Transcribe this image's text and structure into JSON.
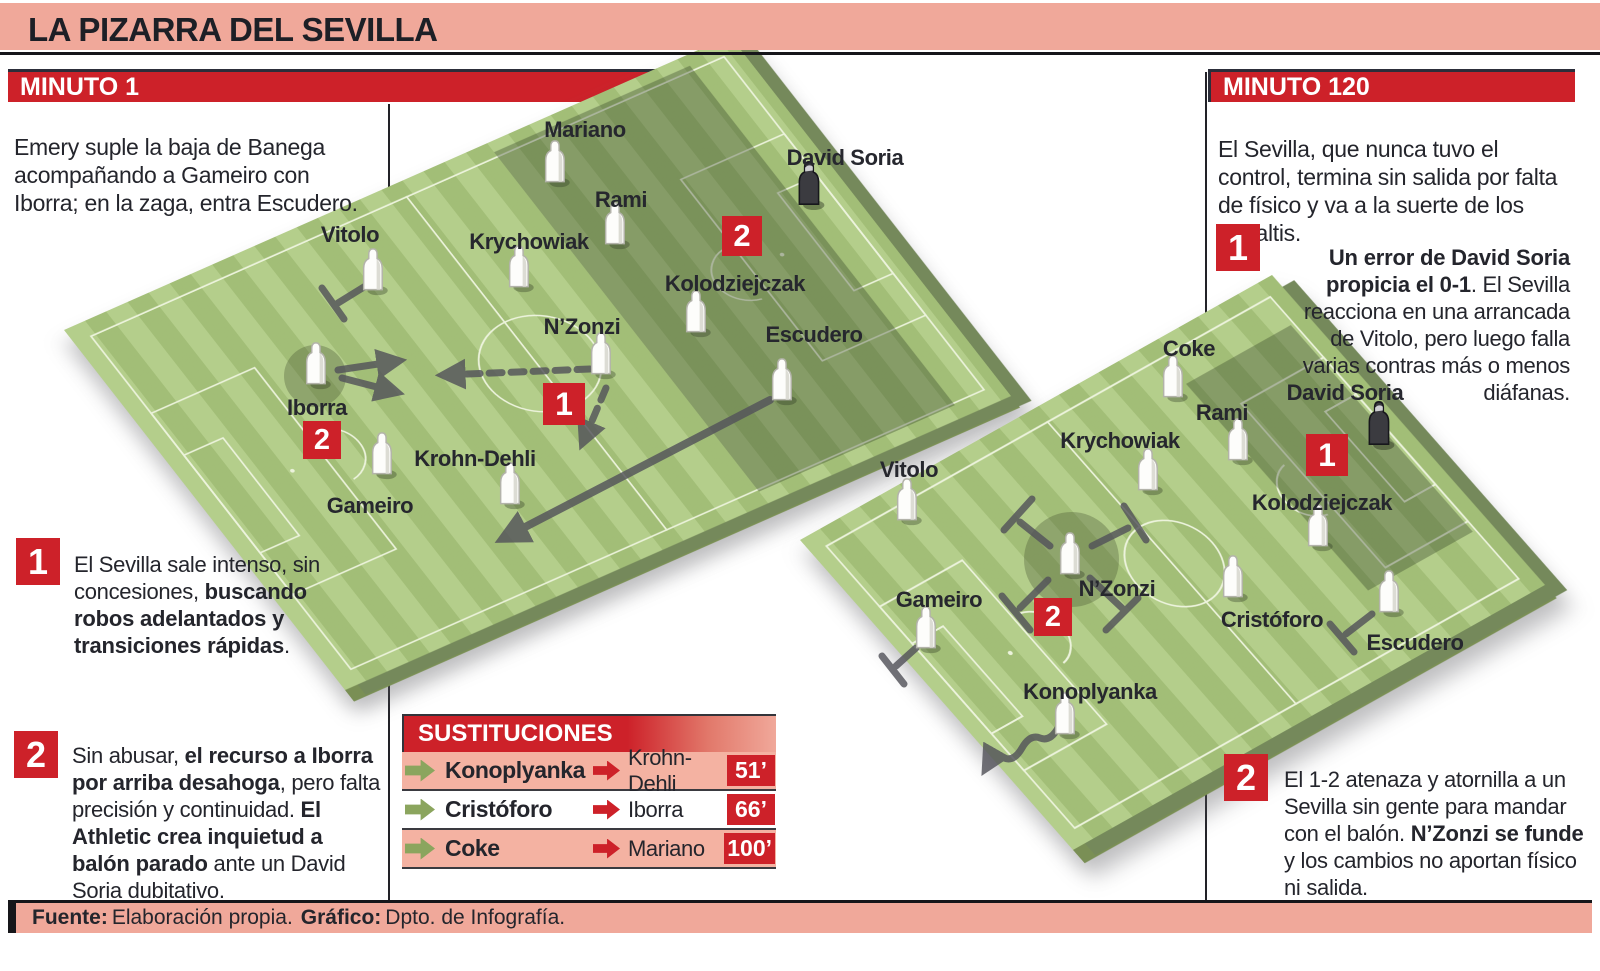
{
  "title": "LA PIZARRA DEL SEVILLA",
  "minuto1": {
    "header": "MINUTO 1",
    "intro": "Emery suple la baja de Banega acompañando a Gameiro con Iborra; en la zaga, entra Escudero.",
    "note1": {
      "num": "1",
      "s0": "El Sevilla sale intenso, sin concesiones, ",
      "b1": "buscando robos adelantados y transiciones rápidas",
      "s2": "."
    },
    "note2": {
      "num": "2",
      "s0": "Sin abusar, ",
      "b1": "el recurso a Iborra por arriba desahoga",
      "s2": ", pero falta precisión y continuidad. ",
      "b3": "El Athletic crea inquietud a balón parado",
      "s4": " ante un David Soria dubitativo."
    },
    "badges": {
      "zone": "2",
      "pass": "1",
      "iborra": "2"
    },
    "players": [
      "Mariano",
      "Rami",
      "David Soria",
      "Vitolo",
      "Krychowiak",
      "Kolodziejczak",
      "N’Zonzi",
      "Escudero",
      "Iborra",
      "Krohn-Dehli",
      "Gameiro"
    ]
  },
  "minuto120": {
    "header": "MINUTO 120",
    "intro": "El Sevilla, que nunca tuvo el control, termina sin salida por falta de físico y va a la suerte de los penaltis.",
    "note1": {
      "num": "1",
      "b0": "Un error de David Soria propicia el 0-1",
      "s1": ". El Sevilla reacciona en una arrancada de Vitolo, pero luego falla varias contras más o menos diáfanas."
    },
    "note2": {
      "num": "2",
      "s0": "El 1-2 atenaza y atornilla a un Sevilla sin gente para mandar con el balón. ",
      "b1": "N’Zonzi se funde",
      "s2": " y los cambios no aportan físico ni salida."
    },
    "badges": {
      "zone": "1",
      "nzonzi": "2"
    },
    "players": [
      "Coke",
      "Rami",
      "David Soria",
      "Krychowiak",
      "Vitolo",
      "Kolodziejczak",
      "N’Zonzi",
      "Gameiro",
      "Cristóforo",
      "Escudero",
      "Konoplyanka"
    ]
  },
  "substitutions": {
    "header": "SUSTITUCIONES",
    "rows": [
      {
        "player_in": "Konoplyanka",
        "player_out": "Krohn-Dehli",
        "minute": "51’"
      },
      {
        "player_in": "Cristóforo",
        "player_out": "Iborra",
        "minute": "66’"
      },
      {
        "player_in": "Coke",
        "player_out": "Mariano",
        "minute": "100’"
      }
    ]
  },
  "footer": {
    "source_label": "Fuente:",
    "source_text": "Elaboración propia.",
    "graphic_label": "Gráfico:",
    "graphic_text": "Dpto. de Infografía."
  },
  "colors": {
    "accent_red": "#cd2129",
    "salmon": "#f0a89a",
    "field_green": "#adc980",
    "board_side": "#7a8f55",
    "text_dark": "#24252c"
  }
}
